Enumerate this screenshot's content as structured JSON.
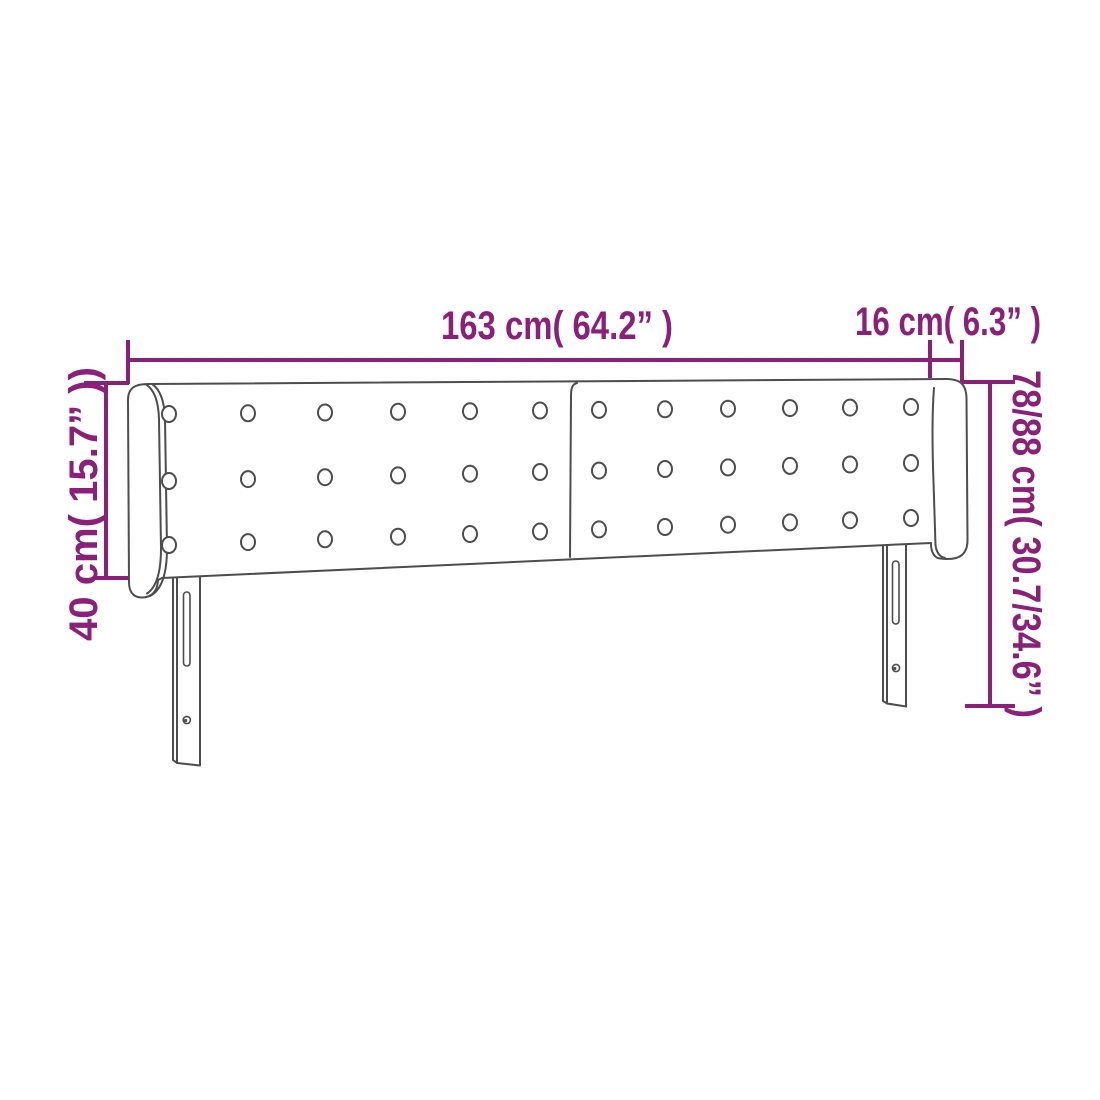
{
  "diagram": {
    "title": "headboard-with-ears-dimension-diagram",
    "colors": {
      "dimension_accent": "#8b2079",
      "drawing_outline": "#4d4d4d",
      "background": "#ffffff"
    },
    "dimensions": {
      "main_width": {
        "label": "163 cm( 64.2” )"
      },
      "side_wing_width": {
        "label": "16 cm( 6.3” )"
      },
      "panel_height": {
        "label": "40 cm( 15.7” ))"
      },
      "total_height": {
        "label": "78/88 cm( 30.7/34.6” )"
      }
    },
    "drawing": {
      "button_rows_per_half": 3,
      "button_columns_per_half": 6,
      "legs": 2
    }
  }
}
